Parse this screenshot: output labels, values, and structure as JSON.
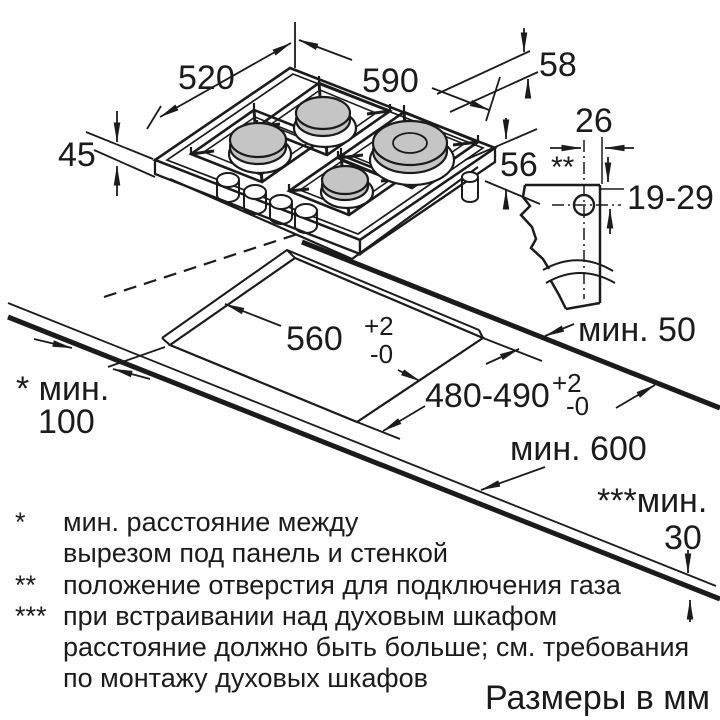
{
  "caption": "Размеры в мм",
  "dimensions": {
    "hob_depth": "520",
    "hob_width": "590",
    "hob_total_height": "58",
    "hob_body_height": "45",
    "built_in_depth": "56",
    "gas_hole_offset": "26",
    "gas_hole_marker": "**",
    "gas_hole_height_range": "19-29",
    "cutout_width": "560",
    "cutout_width_tol_upper": "+2",
    "cutout_width_tol_lower": "-0",
    "cutout_depth": "480-490",
    "cutout_depth_tol_upper": "+2",
    "cutout_depth_tol_lower": "-0",
    "min_to_edge": "мин. 50",
    "min_worktop_depth": "мин. 600",
    "min_wall_clearance_label": "* мин.",
    "min_wall_clearance_value": "100",
    "min_oven_clearance_label": "***мин.",
    "min_oven_clearance_value": "30"
  },
  "footnotes": {
    "f1_marker": "*",
    "f1_line1": "мин. расстояние между",
    "f1_line2": "вырезом под панель и стенкой",
    "f2_marker": "**",
    "f2_line1": "положение отверстия для подключения газа",
    "f3_marker": "***",
    "f3_line1": "при встраивании над духовым шкафом",
    "f3_line2": "расстояние должно быть больше; см. требования",
    "f3_line3": "по монтажу духовых шкафов"
  }
}
